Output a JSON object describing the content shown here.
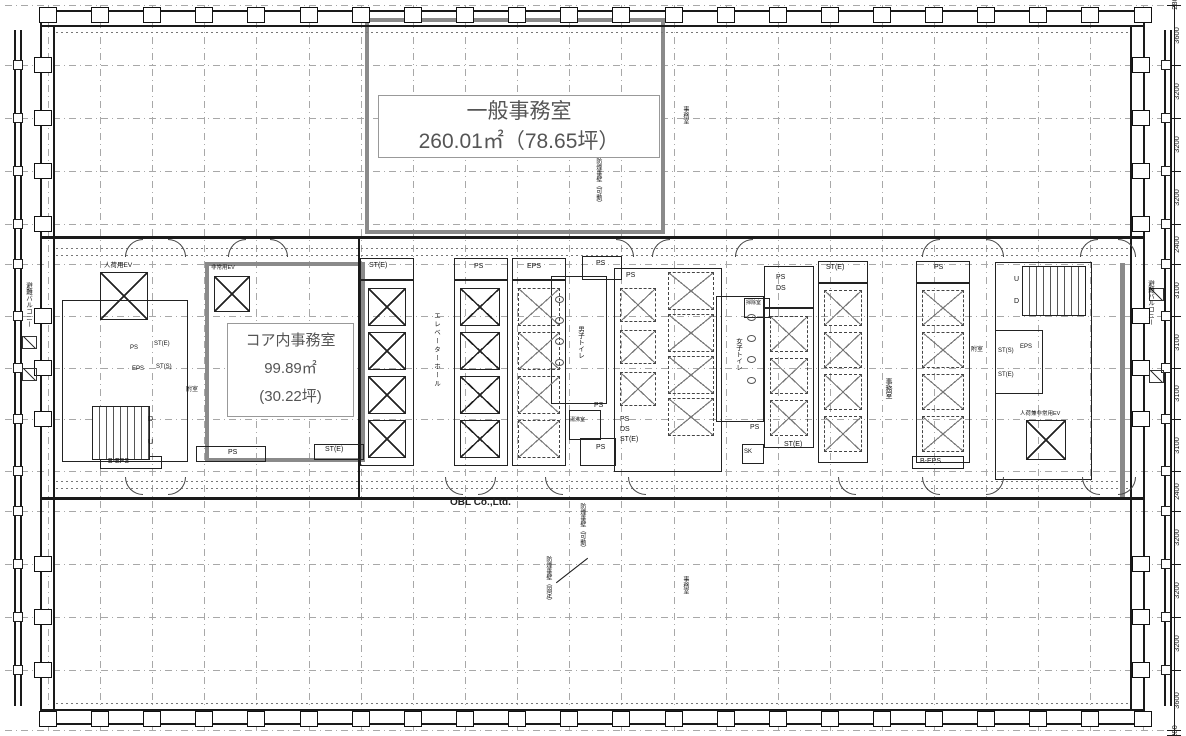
{
  "plan": {
    "watermark": "OBL Co.,Ltd."
  },
  "rooms": {
    "general_office": {
      "name": "一般事務室",
      "area": "260.01㎡（78.65坪）"
    },
    "core_office": {
      "name": "コア内事務室",
      "area_m2": "99.89㎡",
      "area_tsubo": "(30.22坪)"
    },
    "office": "事務室",
    "elevator_hall": "エレベーターホール",
    "mens_toilet": "男子トイレ",
    "womens_toilet": "女子トイレ",
    "anteroom": "附室",
    "kitchenette": "湯沸室",
    "cleaning_room": "掃除室",
    "evacuation_balcony": "避難バルコニー"
  },
  "elevators": {
    "freight": "人荷用EV",
    "emergency": "非常用EV",
    "freight_emergency": "人荷兼非常用EV"
  },
  "shafts": {
    "ps": "PS",
    "eps": "EPS",
    "b_eps": "B-EPS",
    "st_e": "ST(E)",
    "st_s": "ST(S)",
    "ds": "DS",
    "sk": "SK"
  },
  "stairs": {
    "up": "U",
    "down": "D"
  },
  "notes": {
    "smoke_wall_movable": "防煙垂壁（可動）",
    "smoke_wall_fixed": "防煙垂壁（固定）"
  },
  "dimensions": {
    "right": [
      "280",
      "3600",
      "3200",
      "3200",
      "3200",
      "2400",
      "3100",
      "3100",
      "3100",
      "3100",
      "2400",
      "3200",
      "3200",
      "3200",
      "3600",
      "280"
    ]
  }
}
